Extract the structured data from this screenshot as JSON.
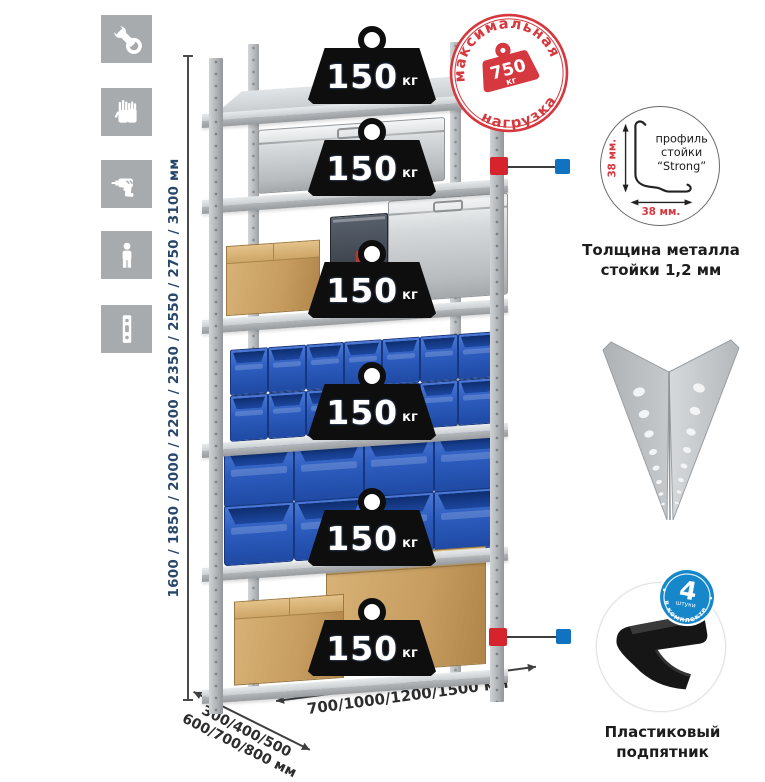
{
  "icons": [
    {
      "name": "wrench-icon"
    },
    {
      "name": "gloves-icon"
    },
    {
      "name": "drill-icon"
    },
    {
      "name": "person-icon"
    },
    {
      "name": "rack-post-icon"
    }
  ],
  "dimensions": {
    "height": "1600 / 1850 / 2000 / 2200 / 2350 / 2550 / 2750 / 3100 мм",
    "depth_line1": "300/400/500",
    "depth_line2": "600/700/800 мм",
    "width": "700/1000/1200/1500 мм"
  },
  "stamp": {
    "arc_top": "максимальная",
    "arc_bottom": "нагрузка",
    "value": "750",
    "unit": "кг"
  },
  "rack": {
    "shelves": [
      {
        "load": "150",
        "unit": "кг",
        "content": "empty"
      },
      {
        "load": "150",
        "unit": "кг",
        "content": "aluminum-case"
      },
      {
        "load": "150",
        "unit": "кг",
        "content": "cardboard-box-and-cases"
      },
      {
        "load": "150",
        "unit": "кг",
        "content": "small-blue-bins"
      },
      {
        "load": "150",
        "unit": "кг",
        "content": "large-blue-bins"
      },
      {
        "load": "150",
        "unit": "кг",
        "content": "cardboard-boxes"
      }
    ]
  },
  "profile_callout": {
    "text_line1": "профиль",
    "text_line2": "стойки",
    "text_line3": "“Strong”",
    "dim_v": "38 мм.",
    "dim_h": "38 мм.",
    "caption1": "Толщина металла",
    "caption2": "стойки 1,2 мм"
  },
  "foot_callout": {
    "count": "4",
    "count_label": "штуки",
    "arc": "в комплекте",
    "caption1": "Пластиковый",
    "caption2": "подпятник"
  }
}
